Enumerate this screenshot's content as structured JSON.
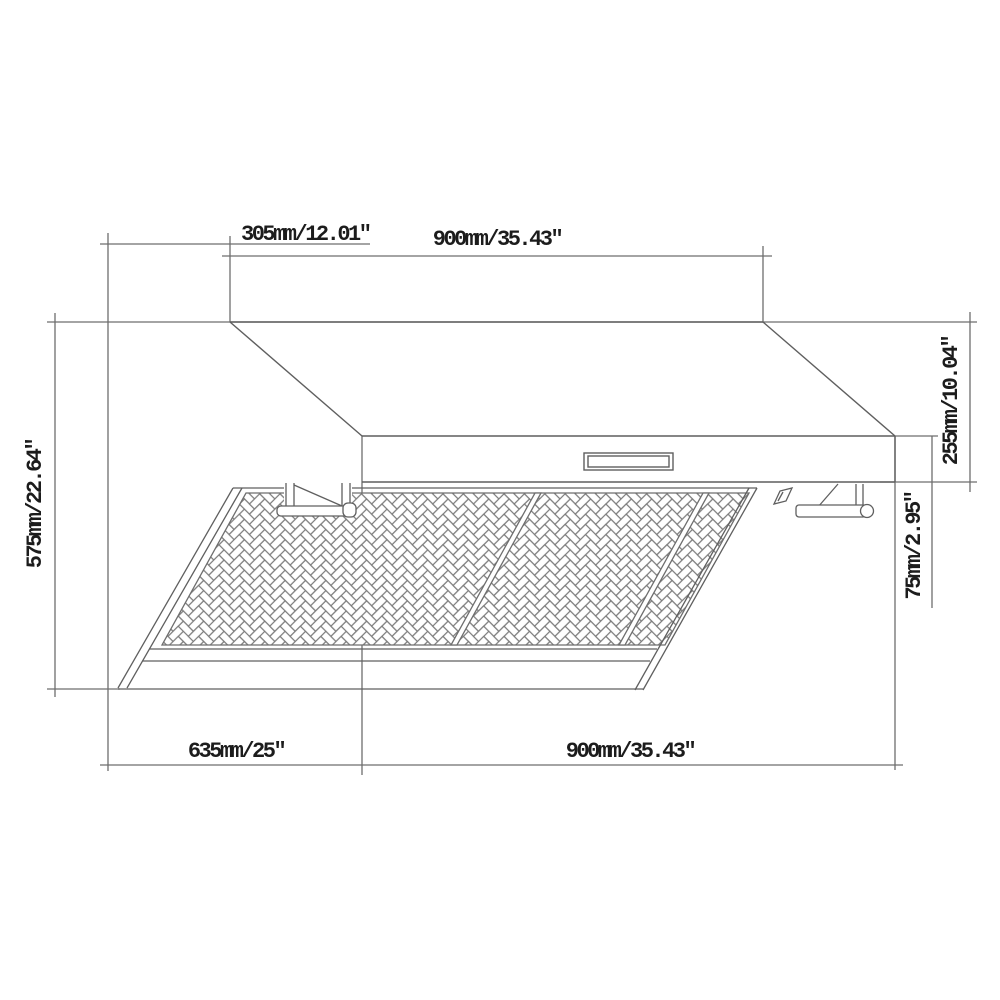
{
  "drawing": {
    "name": "Range hood dimensional line drawing",
    "background": "#ffffff",
    "line_color": "#5f5f5f",
    "dim_line_color": "#6e6e6e",
    "pattern_line_color": "#7a7a7a",
    "text_color": "#1c1c1c",
    "labels": {
      "top_offset": "305mm/12.01″",
      "top_width": "900mm/35.43″",
      "left_height": "575mm/22.64″",
      "right_upper": "255mm/10.04″",
      "right_lower": "75mm/2.95″",
      "bottom_depth": "635mm/25″",
      "bottom_width": "900mm/35.43″"
    }
  }
}
